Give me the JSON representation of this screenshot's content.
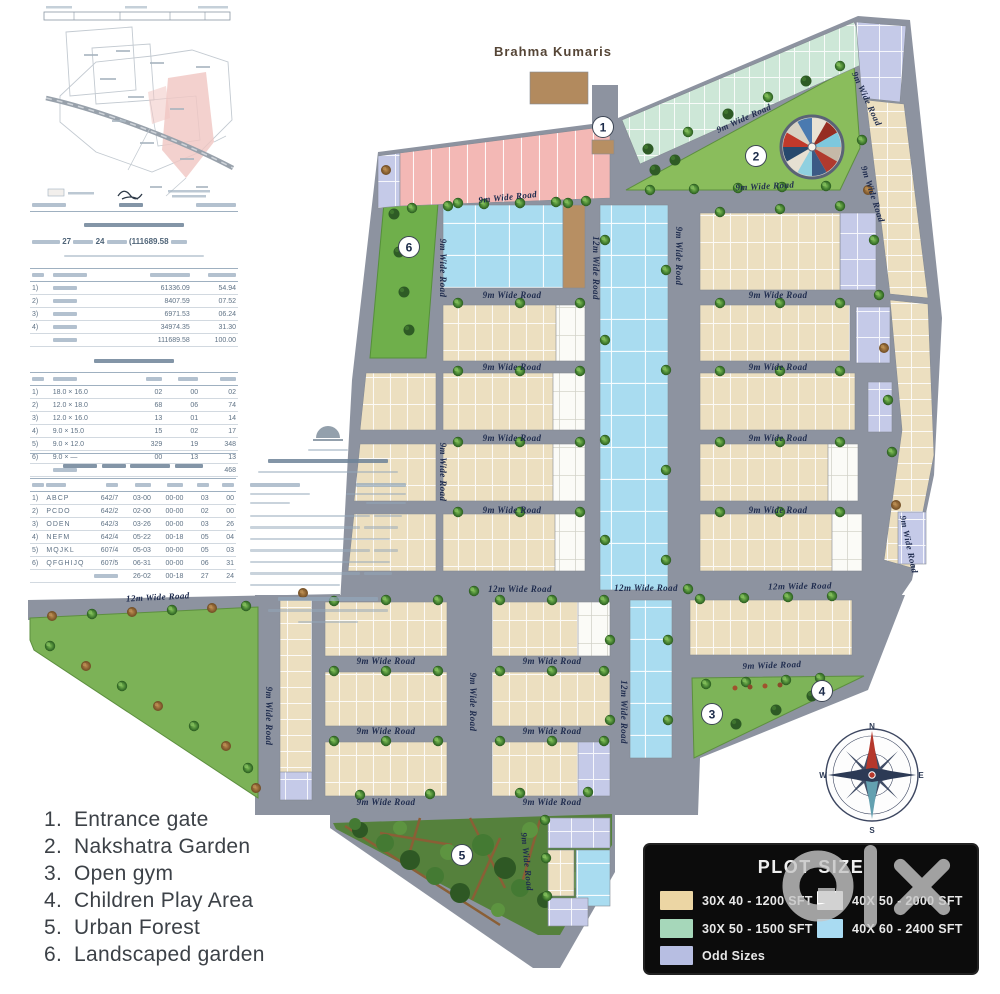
{
  "map": {
    "brahma_label": "Brahma  Kumaris",
    "road_labels": {
      "r9": "9m Wide Road",
      "r12": "12m Wide Road"
    },
    "markers": {
      "m1": "1",
      "m2": "2",
      "m3": "3",
      "m4": "4",
      "m5": "5",
      "m6": "6"
    },
    "compass": {
      "n": "N",
      "e": "E",
      "s": "S",
      "w": "W"
    },
    "colors": {
      "road": "#8d93a0",
      "plot_30x40": "#ecdfc0",
      "plot_30x50": "#cde7d7",
      "plot_40x50": "#fbfbf7",
      "plot_40x60": "#a9dcf0",
      "plot_odd": "#c5cae8",
      "park_green": "#7cb257",
      "forest_green": "#55813c",
      "building_brown": "#b78f63"
    }
  },
  "amenities_list": {
    "items": [
      {
        "num": "1.",
        "label": "Entrance gate"
      },
      {
        "num": "2.",
        "label": "Nakshatra Garden"
      },
      {
        "num": "3.",
        "label": "Open gym"
      },
      {
        "num": "4.",
        "label": "Children Play Area"
      },
      {
        "num": "5.",
        "label": "Urban Forest"
      },
      {
        "num": "6.",
        "label": "Landscaped garden"
      }
    ]
  },
  "plot_size_legend": {
    "title": "PLOT SIZE",
    "items": [
      {
        "label": "30X 40 - 1200 SFT",
        "color": "#ecd6a4"
      },
      {
        "label": "30X 50 - 1500 SFT",
        "color": "#a6d7ba"
      },
      {
        "label": "Odd Sizes",
        "color": "#b7bee2"
      },
      {
        "label": "40X 50 - 2000 SFT",
        "color": "#ffffff"
      },
      {
        "label": "40X 60 - 2400 SFT",
        "color": "#a9dbf2"
      }
    ]
  },
  "survey_doc": {
    "extent_numbers": {
      "acres": "27",
      "guntas": "24",
      "total_sqm": "(111689.58"
    },
    "land_use_rows": [
      [
        "1)",
        "~",
        "61336.09",
        "54.94"
      ],
      [
        "2)",
        "~",
        "8407.59",
        "07.52"
      ],
      [
        "3)",
        "~",
        "6971.53",
        "06.24"
      ],
      [
        "4)",
        "~",
        "34974.35",
        "31.30"
      ],
      [
        "",
        "~",
        "111689.58",
        "100.00"
      ]
    ],
    "plot_mix_rows": [
      [
        "1)",
        "18.0 × 16.0",
        "02",
        "00",
        "02"
      ],
      [
        "2)",
        "12.0 × 18.0",
        "68",
        "06",
        "74"
      ],
      [
        "3)",
        "12.0 × 16.0",
        "13",
        "01",
        "14"
      ],
      [
        "4)",
        "9.0 × 15.0",
        "15",
        "02",
        "17"
      ],
      [
        "5)",
        "9.0 × 12.0",
        "329",
        "19",
        "348"
      ],
      [
        "6)",
        "9.0 × —",
        "00",
        "13",
        "13"
      ],
      [
        "",
        "~",
        "",
        "",
        "468"
      ]
    ],
    "sy_rows": [
      [
        "1)",
        "ABCP",
        "642/7",
        "03-00",
        "00-00",
        "03",
        "00"
      ],
      [
        "2)",
        "PCDO",
        "642/2",
        "02-00",
        "00-00",
        "02",
        "00"
      ],
      [
        "3)",
        "ODEN",
        "642/3",
        "03-26",
        "00-00",
        "03",
        "26"
      ],
      [
        "4)",
        "NEFM",
        "642/4",
        "05-22",
        "00-18",
        "05",
        "04"
      ],
      [
        "5)",
        "MQJKL",
        "607/4",
        "05-03",
        "00-00",
        "05",
        "03"
      ],
      [
        "6)",
        "QFGHIJQ",
        "607/5",
        "06-31",
        "00-00",
        "06",
        "31"
      ],
      [
        "",
        "",
        "~",
        "26-02",
        "00-18",
        "27",
        "24"
      ]
    ]
  }
}
